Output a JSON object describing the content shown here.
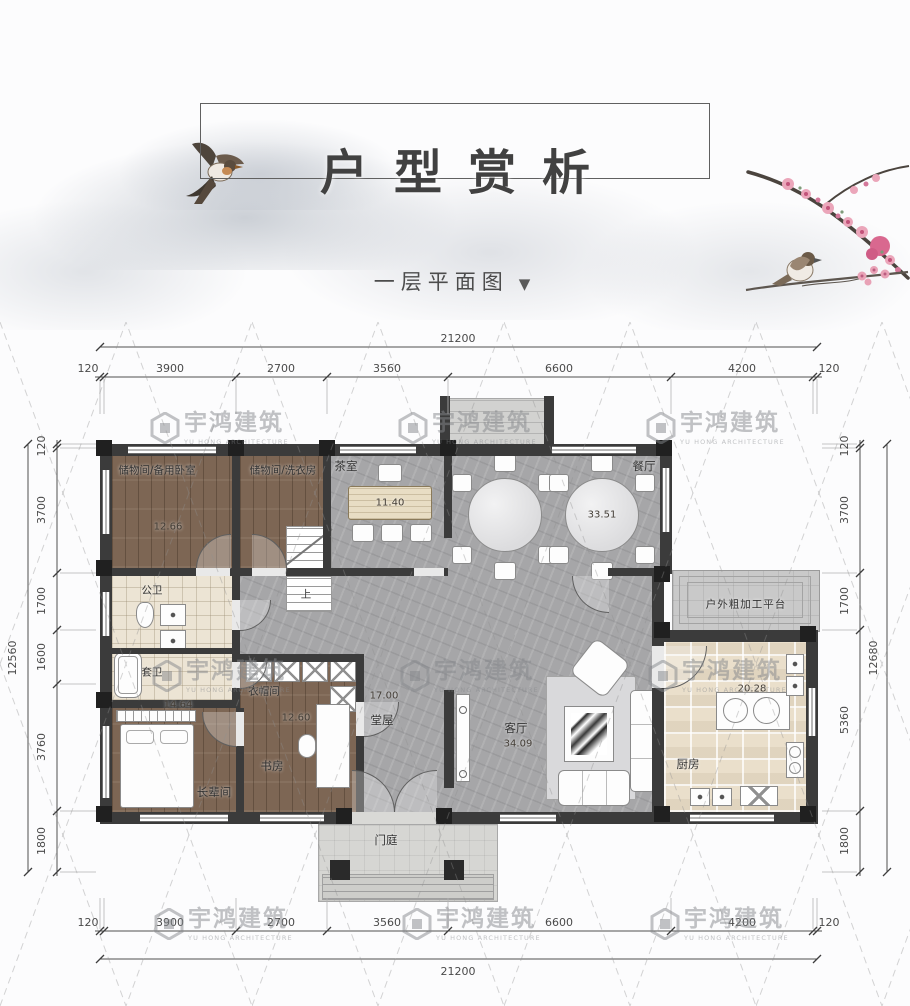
{
  "header": {
    "title": "户型赏析",
    "subtitle": "一层平面图",
    "subtitle_arrow": "▼"
  },
  "watermark": {
    "cn": "宇鸿建筑",
    "en": "YU HONG ARCHITECTURE"
  },
  "dims": {
    "top_total": "21200",
    "top_segments": [
      "120",
      "3900",
      "2700",
      "3560",
      "6600",
      "4200",
      "120"
    ],
    "bottom_total": "21200",
    "bottom_segments": [
      "120",
      "3900",
      "2700",
      "3560",
      "6600",
      "4200",
      "120"
    ],
    "left_total": "12560",
    "left_segments": [
      "120",
      "3700",
      "1700",
      "1600",
      "3760",
      "1800"
    ],
    "right_total": "12680",
    "right_segments": [
      "120",
      "3700",
      "1700",
      "5360",
      "1800"
    ]
  },
  "rooms": {
    "storage_bedroom": {
      "name": "储物间/备用卧室",
      "area": "12.66"
    },
    "storage_laundry": {
      "name": "储物间/洗衣房"
    },
    "tea_room": {
      "name": "茶室",
      "area": "11.40"
    },
    "dining": {
      "name": "餐厅",
      "area": "33.51"
    },
    "public_bath": {
      "name": "公卫"
    },
    "suite_bath": {
      "name": "套卫"
    },
    "cloakroom": {
      "name": "衣帽间"
    },
    "elder_room": {
      "name": "长辈间",
      "area": "14.64"
    },
    "study": {
      "name": "书房",
      "area": "12.60"
    },
    "hall": {
      "name": "堂屋",
      "area": "17.00"
    },
    "living": {
      "name": "客厅",
      "area": "34.09"
    },
    "kitchen": {
      "name": "厨房",
      "area": "20.28"
    },
    "platform": {
      "name": "户外粗加工平台"
    },
    "porch": {
      "name": "门庭"
    }
  },
  "annotations": {
    "stair_up": "上"
  },
  "colors": {
    "wall": "#3b3b3b",
    "wood_floor": "#7d6654",
    "marble_floor": "#a6a6a8",
    "bath_tile": "#ece4d4",
    "kitchen_tile": "#eadfcb",
    "blossom_pink": "#e8a0b4"
  }
}
